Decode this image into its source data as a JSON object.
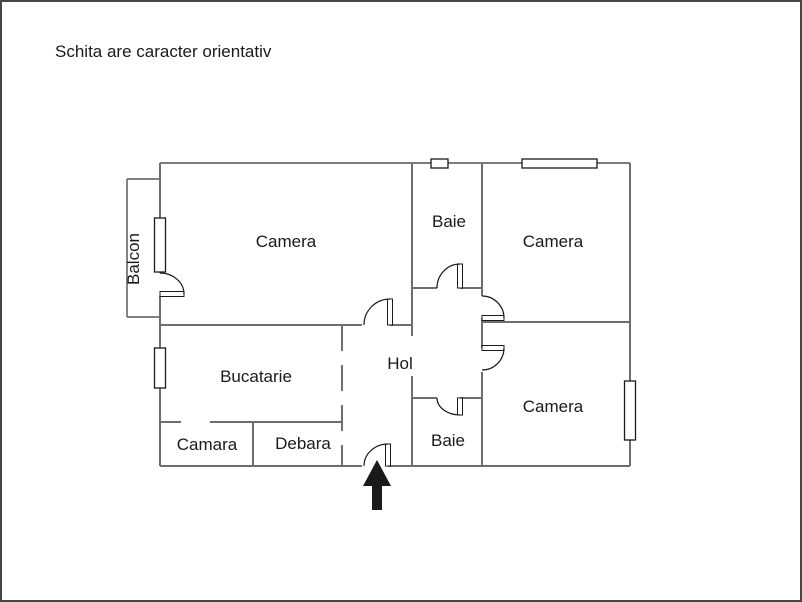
{
  "title": "Schita are caracter orientativ",
  "rooms": {
    "balcon": "Balcon",
    "camera_top_left": "Camera",
    "baie_top": "Baie",
    "camera_top_right": "Camera",
    "bucatarie": "Bucatarie",
    "hol": "Hol",
    "camara": "Camara",
    "debara": "Debara",
    "baie_bottom": "Baie",
    "camera_bottom_right": "Camera"
  },
  "colors": {
    "wall": "#6e6e6e",
    "outline": "#2f2f2f",
    "feature": "#1a1a1a",
    "text": "#1a1a1a",
    "page_border": "#474747",
    "background": "#ffffff"
  }
}
